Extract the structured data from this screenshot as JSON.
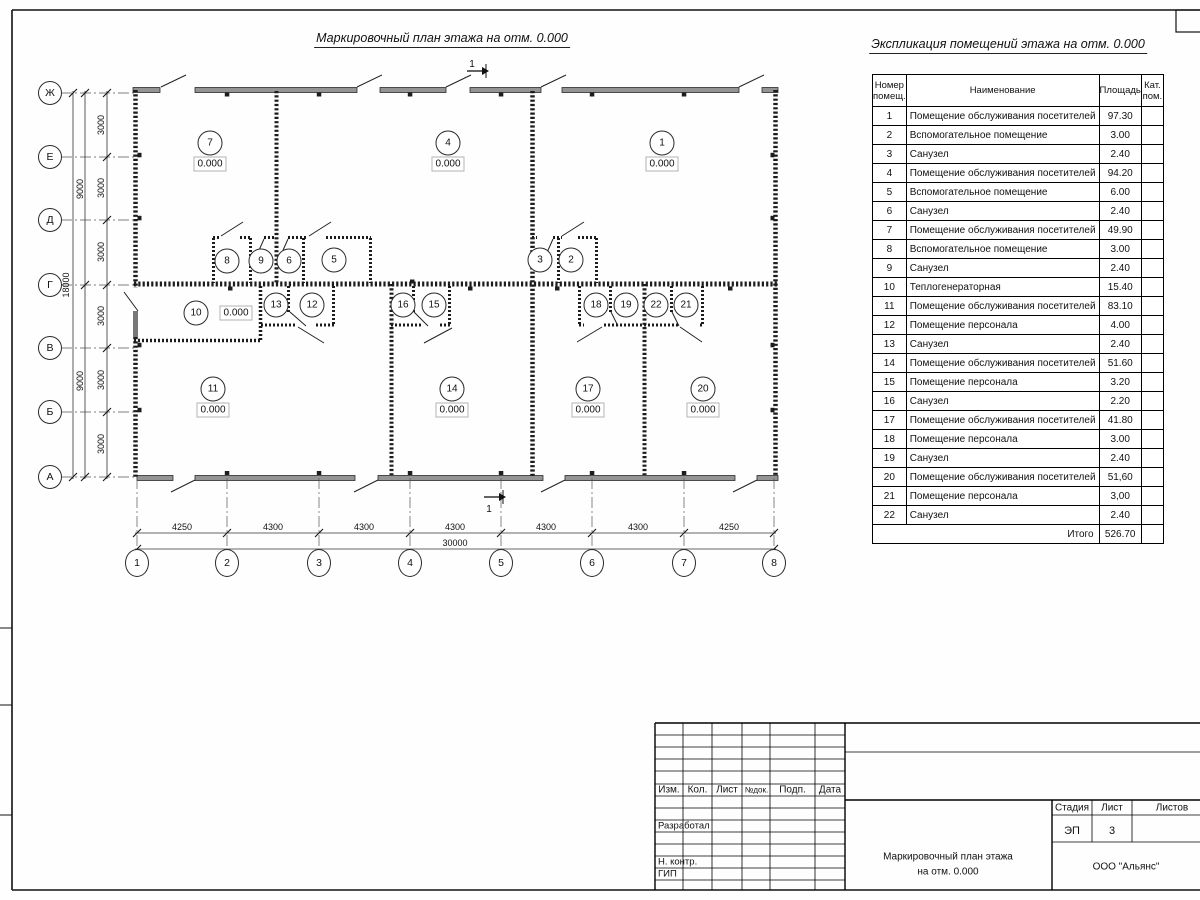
{
  "plan": {
    "title": "Маркировочный план этажа на отм. 0.000",
    "section_mark": "1",
    "row_axes": [
      {
        "label": "Ж",
        "y": 93
      },
      {
        "label": "Е",
        "y": 157
      },
      {
        "label": "Д",
        "y": 220
      },
      {
        "label": "Г",
        "y": 285
      },
      {
        "label": "В",
        "y": 348
      },
      {
        "label": "Б",
        "y": 412
      },
      {
        "label": "А",
        "y": 477
      }
    ],
    "col_axes": [
      {
        "label": "1",
        "x": 137
      },
      {
        "label": "2",
        "x": 227
      },
      {
        "label": "3",
        "x": 319
      },
      {
        "label": "4",
        "x": 410
      },
      {
        "label": "5",
        "x": 501
      },
      {
        "label": "6",
        "x": 592
      },
      {
        "label": "7",
        "x": 684
      },
      {
        "label": "8",
        "x": 774
      }
    ],
    "dim_segments_bottom": [
      {
        "label": "4250",
        "x": 182
      },
      {
        "label": "4300",
        "x": 273
      },
      {
        "label": "4300",
        "x": 364
      },
      {
        "label": "4300",
        "x": 455
      },
      {
        "label": "4300",
        "x": 546
      },
      {
        "label": "4300",
        "x": 638
      },
      {
        "label": "4250",
        "x": 729
      }
    ],
    "dim_total_bottom": {
      "label": "30000",
      "x": 455,
      "y": 543
    },
    "dim_segments_left": [
      {
        "label": "3000",
        "y": 125
      },
      {
        "label": "3000",
        "y": 188
      },
      {
        "label": "3000",
        "y": 252
      },
      {
        "label": "3000",
        "y": 316
      },
      {
        "label": "3000",
        "y": 380
      },
      {
        "label": "3000",
        "y": 444
      }
    ],
    "dim_spans_left": [
      {
        "label": "9000",
        "y": 189
      },
      {
        "label": "9000",
        "y": 381
      }
    ],
    "dim_total_left": {
      "label": "18000",
      "y": 285
    },
    "rooms": [
      {
        "num": "7",
        "x": 210,
        "y": 143,
        "elev": "0.000"
      },
      {
        "num": "4",
        "x": 448,
        "y": 143,
        "elev": "0.000"
      },
      {
        "num": "1",
        "x": 662,
        "y": 143,
        "elev": "0.000"
      },
      {
        "num": "8",
        "x": 227,
        "y": 261
      },
      {
        "num": "9",
        "x": 261,
        "y": 261
      },
      {
        "num": "6",
        "x": 289,
        "y": 261
      },
      {
        "num": "5",
        "x": 334,
        "y": 260
      },
      {
        "num": "3",
        "x": 540,
        "y": 260
      },
      {
        "num": "2",
        "x": 571,
        "y": 260
      },
      {
        "num": "10",
        "x": 196,
        "y": 313,
        "elev": "0.000",
        "elev_pos": "right"
      },
      {
        "num": "13",
        "x": 276,
        "y": 305
      },
      {
        "num": "12",
        "x": 312,
        "y": 305
      },
      {
        "num": "16",
        "x": 403,
        "y": 305
      },
      {
        "num": "15",
        "x": 434,
        "y": 305
      },
      {
        "num": "18",
        "x": 596,
        "y": 305
      },
      {
        "num": "19",
        "x": 626,
        "y": 305
      },
      {
        "num": "22",
        "x": 656,
        "y": 305
      },
      {
        "num": "21",
        "x": 686,
        "y": 305
      },
      {
        "num": "11",
        "x": 213,
        "y": 389,
        "elev": "0.000"
      },
      {
        "num": "14",
        "x": 452,
        "y": 389,
        "elev": "0.000"
      },
      {
        "num": "17",
        "x": 588,
        "y": 389,
        "elev": "0.000"
      },
      {
        "num": "20",
        "x": 703,
        "y": 389,
        "elev": "0.000"
      }
    ]
  },
  "table": {
    "title": "Экспликация помещений этажа на отм. 0.000",
    "headers": {
      "num": "Номер\nпомещ.",
      "name": "Наименование",
      "area": "Площадь",
      "cat": "Кат.\nпом."
    },
    "rows": [
      [
        "1",
        "Помещение обслуживания посетителей",
        "97.30"
      ],
      [
        "2",
        "Вспомогательное помещение",
        "3.00"
      ],
      [
        "3",
        "Санузел",
        "2.40"
      ],
      [
        "4",
        "Помещение обслуживания посетителей",
        "94.20"
      ],
      [
        "5",
        "Вспомогательное помещение",
        "6.00"
      ],
      [
        "6",
        "Санузел",
        "2.40"
      ],
      [
        "7",
        "Помещение обслуживания посетителей",
        "49.90"
      ],
      [
        "8",
        "Вспомогательное помещение",
        "3.00"
      ],
      [
        "9",
        "Санузел",
        "2.40"
      ],
      [
        "10",
        "Теплогенераторная",
        "15.40"
      ],
      [
        "11",
        "Помещение обслуживания посетителей",
        "83.10"
      ],
      [
        "12",
        "Помещение персонала",
        "4.00"
      ],
      [
        "13",
        "Санузел",
        "2.40"
      ],
      [
        "14",
        "Помещение обслуживания посетителей",
        "51.60"
      ],
      [
        "15",
        "Помещение персонала",
        "3.20"
      ],
      [
        "16",
        "Санузел",
        "2.20"
      ],
      [
        "17",
        "Помещение обслуживания посетителей",
        "41.80"
      ],
      [
        "18",
        "Помещение персонала",
        "3.00"
      ],
      [
        "19",
        "Санузел",
        "2.40"
      ],
      [
        "20",
        "Помещение обслуживания посетителей",
        "51,60"
      ],
      [
        "21",
        "Помещение персонала",
        "3,00"
      ],
      [
        "22",
        "Санузел",
        "2.40"
      ]
    ],
    "total_label": "Итого",
    "total_value": "526.70"
  },
  "title_block": {
    "revision_headers": [
      "Изм.",
      "Кол.",
      "Лист",
      "№док.",
      "Подп.",
      "Дата"
    ],
    "roles": [
      "Разработал",
      "Н. контр.",
      "ГИП"
    ],
    "stage_label": "Стадия",
    "sheet_label": "Лист",
    "sheets_label": "Листов",
    "stage_value": "ЭП",
    "sheet_value": "3",
    "doc_title_line1": "Маркировочный план этажа",
    "doc_title_line2": "на отм. 0.000",
    "organization": "ООО \"Альянс\""
  }
}
